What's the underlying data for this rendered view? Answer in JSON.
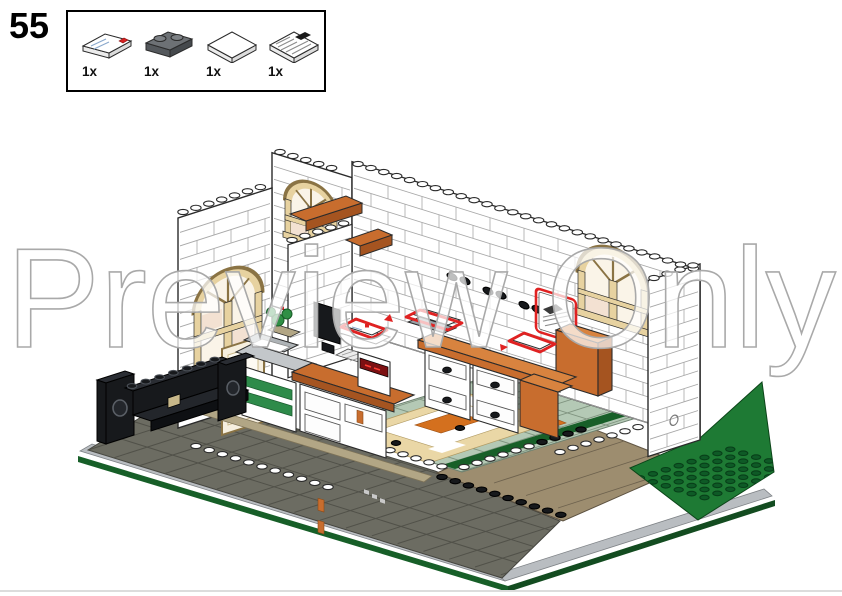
{
  "step": {
    "number": "55"
  },
  "parts_box": {
    "items": [
      {
        "count": "1x",
        "name": "white 1x2 tile with envelope print"
      },
      {
        "count": "1x",
        "name": "dark gray 1x2 plate"
      },
      {
        "count": "1x",
        "name": "white 2x2 tile"
      },
      {
        "count": "1x",
        "name": "white 2x2 tile with newspaper print"
      }
    ]
  },
  "watermark": {
    "text": "Preview Only"
  },
  "colors": {
    "outline": "#2b2b2b",
    "wall": "#ffffff",
    "wallLine": "#a8a8a8",
    "windowTan": "#e7d2a0",
    "windowTanDark": "#8a7344",
    "paneCream": "#faf4e8",
    "panePeach": "#f3e1d2",
    "doorCream": "#f6efdf",
    "orange": "#c86d2e",
    "orangeDark": "#a55420",
    "floor": "#b4c9b5",
    "floorLine": "#7f937f",
    "rugTan": "#ead7a6",
    "rugOrange": "#d4701e",
    "sidewalk": "#6c6c62",
    "sidewalkLine": "#515149",
    "curb": "#b9bdc1",
    "tanPath": "#9d8d6f",
    "tanPathLine": "#6e624e",
    "tanStrip": "#b2a685",
    "green": "#1e7a34",
    "greenDark": "#0e5a26",
    "greenEdge": "#175f28",
    "black": "#17191c",
    "blackHi": "#46505a",
    "grayPlate": "#9aa0a6",
    "copier": "#c3c7ca",
    "drawerGreen": "#2e8b4a",
    "red": "#e02222",
    "displayRed": "#7c1012",
    "watermarkStroke": "#a9a9a9"
  }
}
